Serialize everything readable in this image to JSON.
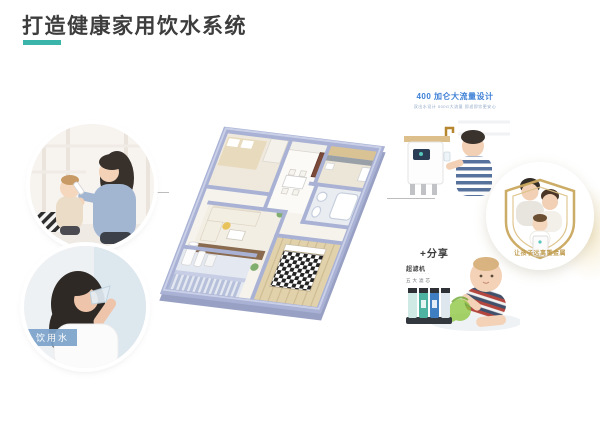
{
  "page": {
    "title": "打造健康家用饮水系统",
    "accent_color": "#3bb5aa"
  },
  "left_photos": {
    "drinking_water_label": "饮用水"
  },
  "right_panel": {
    "top_card": {
      "title": "400 加仑大流量设计",
      "subtitle": "双出水设计 500G大流量 即滤即饮更安心"
    },
    "middle_circle": {
      "caption": "让孩子远离重金属",
      "subcaption": "· · · · · ·"
    },
    "bottom_card": {
      "share_label": "+分享",
      "product_label": "超滤机",
      "product_sub": "· · · · · · · ·",
      "feature_label": "五大滤芯"
    }
  }
}
